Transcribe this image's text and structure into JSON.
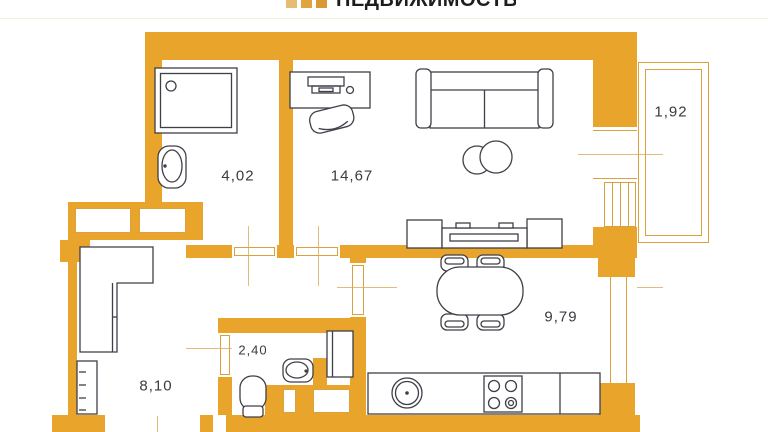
{
  "logo": {
    "text": "НЕДВИЖИМОСТЬ"
  },
  "colors": {
    "wall": "#E9A42C",
    "outline": "#3F3F47",
    "thin": "#D9A23F",
    "swing": "#D8AB5F",
    "label": "#3A3A42",
    "logo_text": "#1D1D1F",
    "logo_sq1": "#E7BC72",
    "logo_sq2": "#E0A33F",
    "logo_sq3": "#D99A35",
    "divider": "#F5EFE1"
  },
  "rooms": {
    "bathroom": {
      "area": "4,02"
    },
    "living_room": {
      "area": "14,67"
    },
    "balcony": {
      "area": "1,92"
    },
    "kitchen": {
      "area": "9,79"
    },
    "wc": {
      "area": "2,40"
    },
    "hallway": {
      "area": "8,10"
    }
  }
}
